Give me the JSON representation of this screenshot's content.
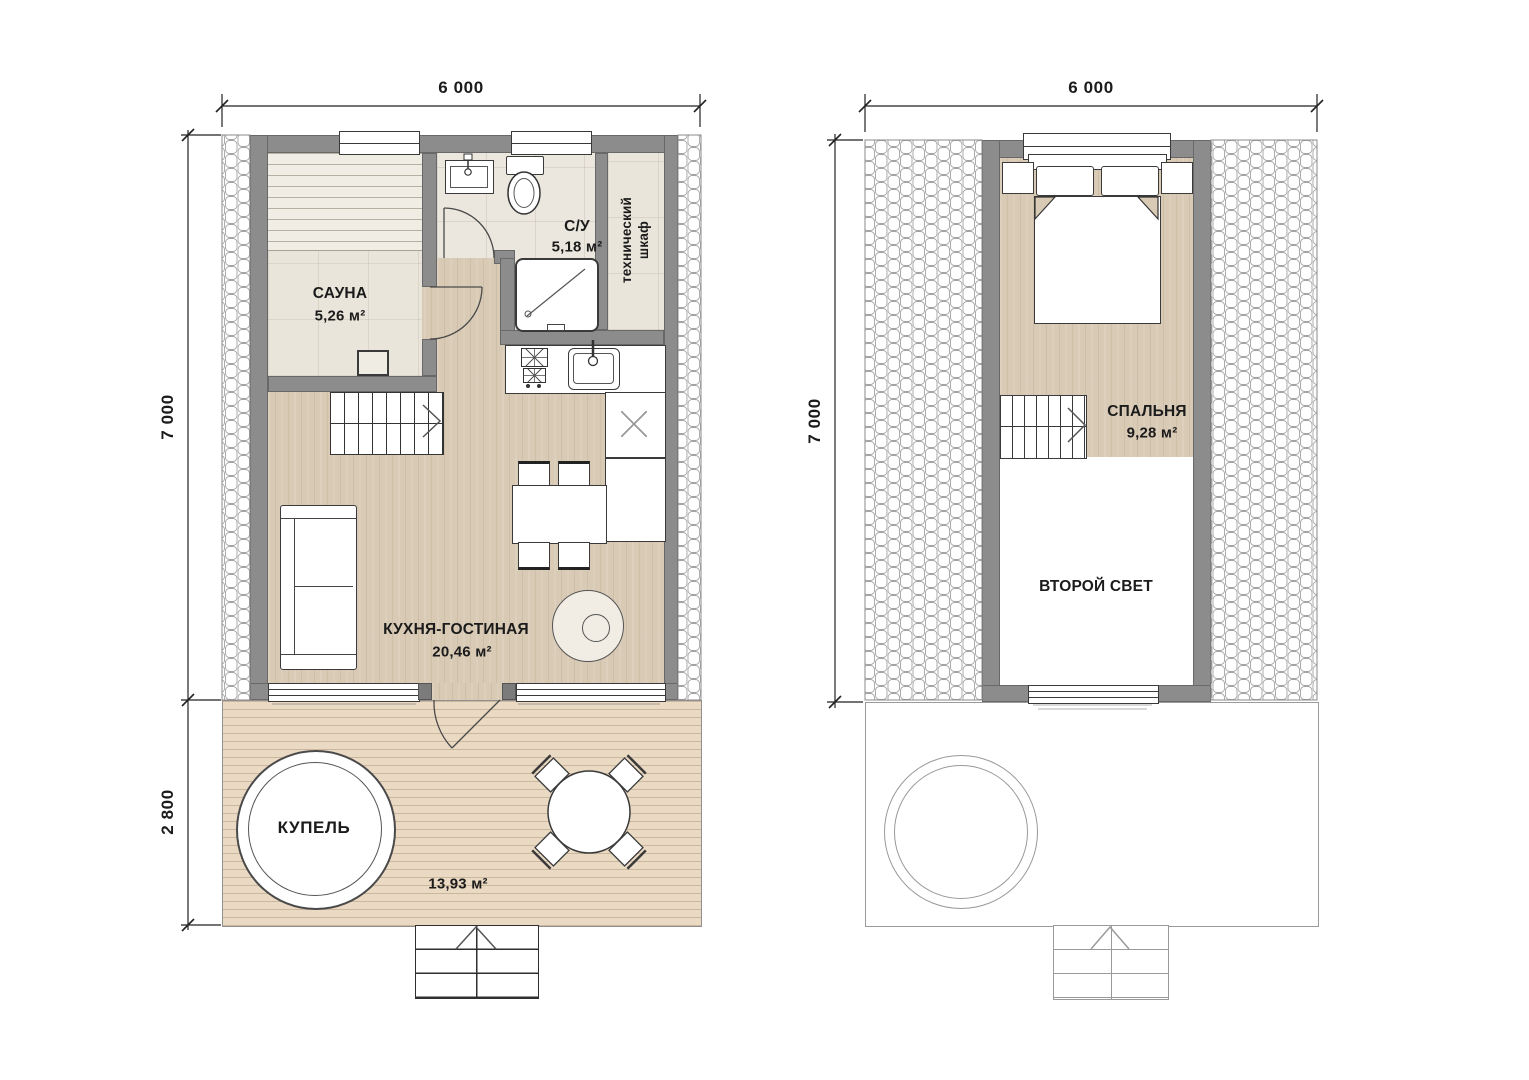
{
  "plans": {
    "first_floor": {
      "dimensions": {
        "width": "6 000",
        "height": "7 000",
        "terrace_depth": "2 800"
      },
      "rooms": {
        "sauna": {
          "name": "САУНА",
          "area": "5,26 м²"
        },
        "bathroom": {
          "name": "С/У",
          "area": "5,18 м²"
        },
        "tech_closet": {
          "name": "технический шкаф"
        },
        "kitchen_living": {
          "name": "КУХНЯ-ГОСТИНАЯ",
          "area": "20,46 м²"
        },
        "hot_tub": {
          "name": "КУПЕЛЬ"
        },
        "terrace": {
          "area": "13,93 м²"
        }
      }
    },
    "second_floor": {
      "dimensions": {
        "width": "6 000",
        "height": "7 000"
      },
      "rooms": {
        "bedroom": {
          "name": "СПАЛЬНЯ",
          "area": "9,28 м²"
        },
        "second_light": {
          "name": "ВТОРОЙ СВЕТ"
        }
      }
    }
  },
  "colors": {
    "wall": "#8c8c8c",
    "wood_floor": "#d8cab5",
    "tile_floor": "#ebe7de",
    "deck": "#ead9c3",
    "fixture_outline": "#333333",
    "hatch_line": "#a3a3a3"
  }
}
